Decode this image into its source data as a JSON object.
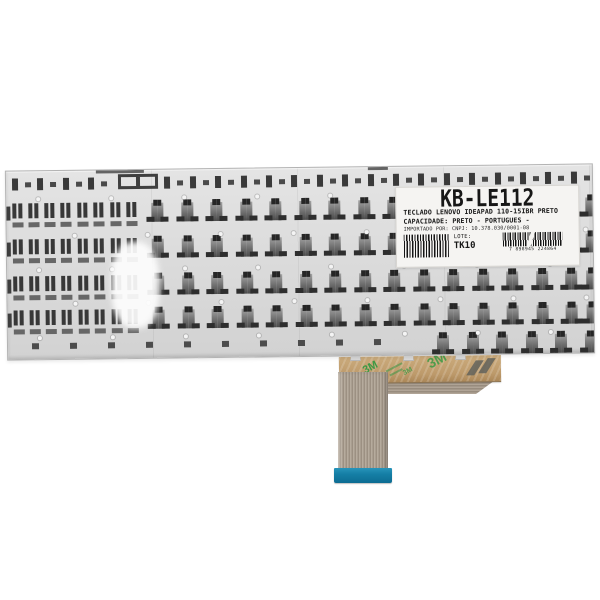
{
  "product_label": {
    "title": "KB-LE112",
    "line1": "TECLADO LENOVO IDEAPAD 110-15IBR PRETO",
    "line2": "CAPACIDADE: PRETO - PORTUGUES -",
    "line3": "IMPORTADO POR: CNPJ: 10.378.030/0001-08",
    "lote_label": "LOTE:",
    "lote_value": "TK10",
    "barcode_digits": "7 898945 224864"
  },
  "tape": {
    "brand": "3M"
  },
  "colors": {
    "background": "#ffffff",
    "plate": "#dadada",
    "plate_edge": "#b3b3b3",
    "clip_dark": "#3a3a3a",
    "clip_mid": "#6b6b6b",
    "label_bg": "#f5f4f2",
    "label_text": "#171717",
    "tape_kraft": "#bd9a6b",
    "tape_brand_green": "#3b9a44",
    "ribbon": "#a89c8e",
    "connector_blue": "#157fa6"
  },
  "texture": {
    "rowA": {
      "y": 7,
      "start": 6,
      "step": 25.4,
      "count": 23,
      "skip_min": 102,
      "skip_max": 156
    },
    "wide_bracket": {
      "x": 112,
      "y": 4
    },
    "hook_rows_y": [
      30,
      66,
      103,
      137
    ],
    "hpair_xs": [
      6,
      38,
      71,
      104
    ],
    "hooks": {
      "start": 140,
      "step": 29.5,
      "end": 560,
      "single": 574
    },
    "rowF": {
      "marks_y": 172,
      "marks_start": 24,
      "marks_step": 38,
      "marks_count": 10,
      "hooks_y": 166,
      "hooks_start": 424,
      "hooks_step": 29.5,
      "hooks_count": 6
    },
    "hole_rows_y": [
      26,
      63,
      97,
      131,
      165
    ],
    "hole_start": 30,
    "hole_alt_offset": 36,
    "hole_step": 73,
    "top_notches": [
      {
        "x": 90,
        "w": 48
      },
      {
        "x": 362,
        "w": 20
      }
    ]
  }
}
